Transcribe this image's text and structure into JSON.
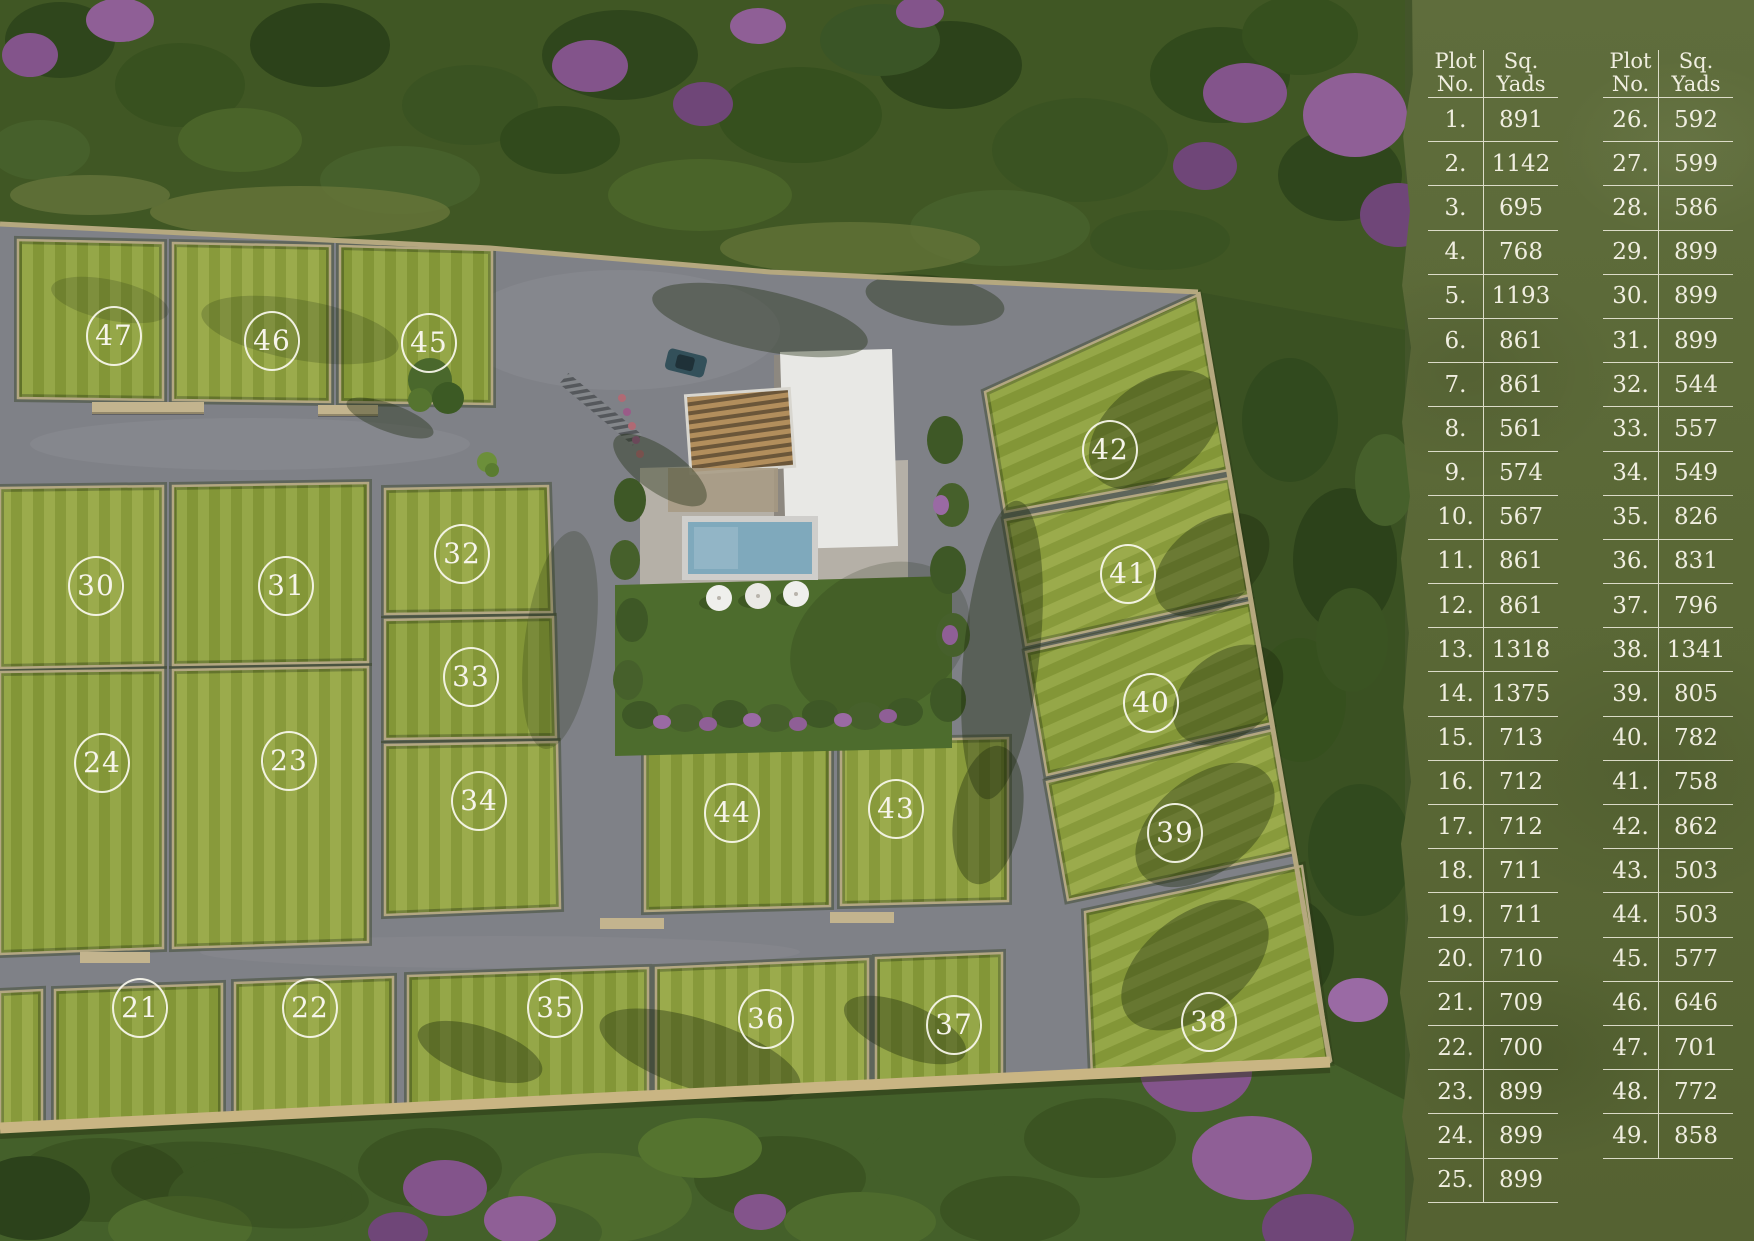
{
  "panel": {
    "bg_color": "#5d6b3a",
    "text_color": "#f0eee0",
    "line_color": "#f2f0e2",
    "headers": {
      "plot_line1": "Plot",
      "plot_line2": "No.",
      "sq_line1": "Sq.",
      "sq_line2": "Yads"
    },
    "tables": [
      {
        "rows": [
          {
            "no": "1.",
            "yards": "891"
          },
          {
            "no": "2.",
            "yards": "1142"
          },
          {
            "no": "3.",
            "yards": "695"
          },
          {
            "no": "4.",
            "yards": "768"
          },
          {
            "no": "5.",
            "yards": "1193"
          },
          {
            "no": "6.",
            "yards": "861"
          },
          {
            "no": "7.",
            "yards": "861"
          },
          {
            "no": "8.",
            "yards": "561"
          },
          {
            "no": "9.",
            "yards": "574"
          },
          {
            "no": "10.",
            "yards": "567"
          },
          {
            "no": "11.",
            "yards": "861"
          },
          {
            "no": "12.",
            "yards": "861"
          },
          {
            "no": "13.",
            "yards": "1318"
          },
          {
            "no": "14.",
            "yards": "1375"
          },
          {
            "no": "15.",
            "yards": "713"
          },
          {
            "no": "16.",
            "yards": "712"
          },
          {
            "no": "17.",
            "yards": "712"
          },
          {
            "no": "18.",
            "yards": "711"
          },
          {
            "no": "19.",
            "yards": "711"
          },
          {
            "no": "20.",
            "yards": "710"
          },
          {
            "no": "21.",
            "yards": "709"
          },
          {
            "no": "22.",
            "yards": "700"
          },
          {
            "no": "23.",
            "yards": "899"
          },
          {
            "no": "24.",
            "yards": "899"
          },
          {
            "no": "25.",
            "yards": "899"
          }
        ]
      },
      {
        "rows": [
          {
            "no": "26.",
            "yards": "592"
          },
          {
            "no": "27.",
            "yards": "599"
          },
          {
            "no": "28.",
            "yards": "586"
          },
          {
            "no": "29.",
            "yards": "899"
          },
          {
            "no": "30.",
            "yards": "899"
          },
          {
            "no": "31.",
            "yards": "899"
          },
          {
            "no": "32.",
            "yards": "544"
          },
          {
            "no": "33.",
            "yards": "557"
          },
          {
            "no": "34.",
            "yards": "549"
          },
          {
            "no": "35.",
            "yards": "826"
          },
          {
            "no": "36.",
            "yards": "831"
          },
          {
            "no": "37.",
            "yards": "796"
          },
          {
            "no": "38.",
            "yards": "1341"
          },
          {
            "no": "39.",
            "yards": "805"
          },
          {
            "no": "40.",
            "yards": "782"
          },
          {
            "no": "41.",
            "yards": "758"
          },
          {
            "no": "42.",
            "yards": "862"
          },
          {
            "no": "43.",
            "yards": "503"
          },
          {
            "no": "44.",
            "yards": "503"
          },
          {
            "no": "45.",
            "yards": "577"
          },
          {
            "no": "46.",
            "yards": "646"
          },
          {
            "no": "47.",
            "yards": "701"
          },
          {
            "no": "48.",
            "yards": "772"
          },
          {
            "no": "49.",
            "yards": "858"
          }
        ]
      }
    ]
  },
  "map": {
    "plots": [
      {
        "label": "47",
        "x": 113,
        "y": 335
      },
      {
        "label": "46",
        "x": 271,
        "y": 340
      },
      {
        "label": "45",
        "x": 428,
        "y": 342
      },
      {
        "label": "30",
        "x": 95,
        "y": 585
      },
      {
        "label": "31",
        "x": 285,
        "y": 585
      },
      {
        "label": "32",
        "x": 461,
        "y": 553
      },
      {
        "label": "33",
        "x": 470,
        "y": 676
      },
      {
        "label": "34",
        "x": 478,
        "y": 800
      },
      {
        "label": "24",
        "x": 101,
        "y": 762
      },
      {
        "label": "23",
        "x": 288,
        "y": 760
      },
      {
        "label": "44",
        "x": 731,
        "y": 812
      },
      {
        "label": "43",
        "x": 895,
        "y": 808
      },
      {
        "label": "42",
        "x": 1109,
        "y": 449
      },
      {
        "label": "41",
        "x": 1127,
        "y": 573
      },
      {
        "label": "40",
        "x": 1150,
        "y": 702
      },
      {
        "label": "39",
        "x": 1174,
        "y": 832
      },
      {
        "label": "21",
        "x": 139,
        "y": 1007
      },
      {
        "label": "22",
        "x": 309,
        "y": 1007
      },
      {
        "label": "35",
        "x": 554,
        "y": 1007
      },
      {
        "label": "36",
        "x": 765,
        "y": 1018
      },
      {
        "label": "37",
        "x": 953,
        "y": 1024
      },
      {
        "label": "38",
        "x": 1208,
        "y": 1021
      }
    ]
  },
  "colors": {
    "plot_grass": "#8da03c",
    "road": "#7f8187",
    "forest_dark": "#2f461c",
    "forest_base": "#405724",
    "blossom": "#83548b",
    "wall": "#b3a782",
    "boundary_wall": "#c9b583",
    "pool_water": "#7fa9bc",
    "garden_lawn": "#4d6c2d",
    "marker_ring": "#f7f5ec"
  }
}
